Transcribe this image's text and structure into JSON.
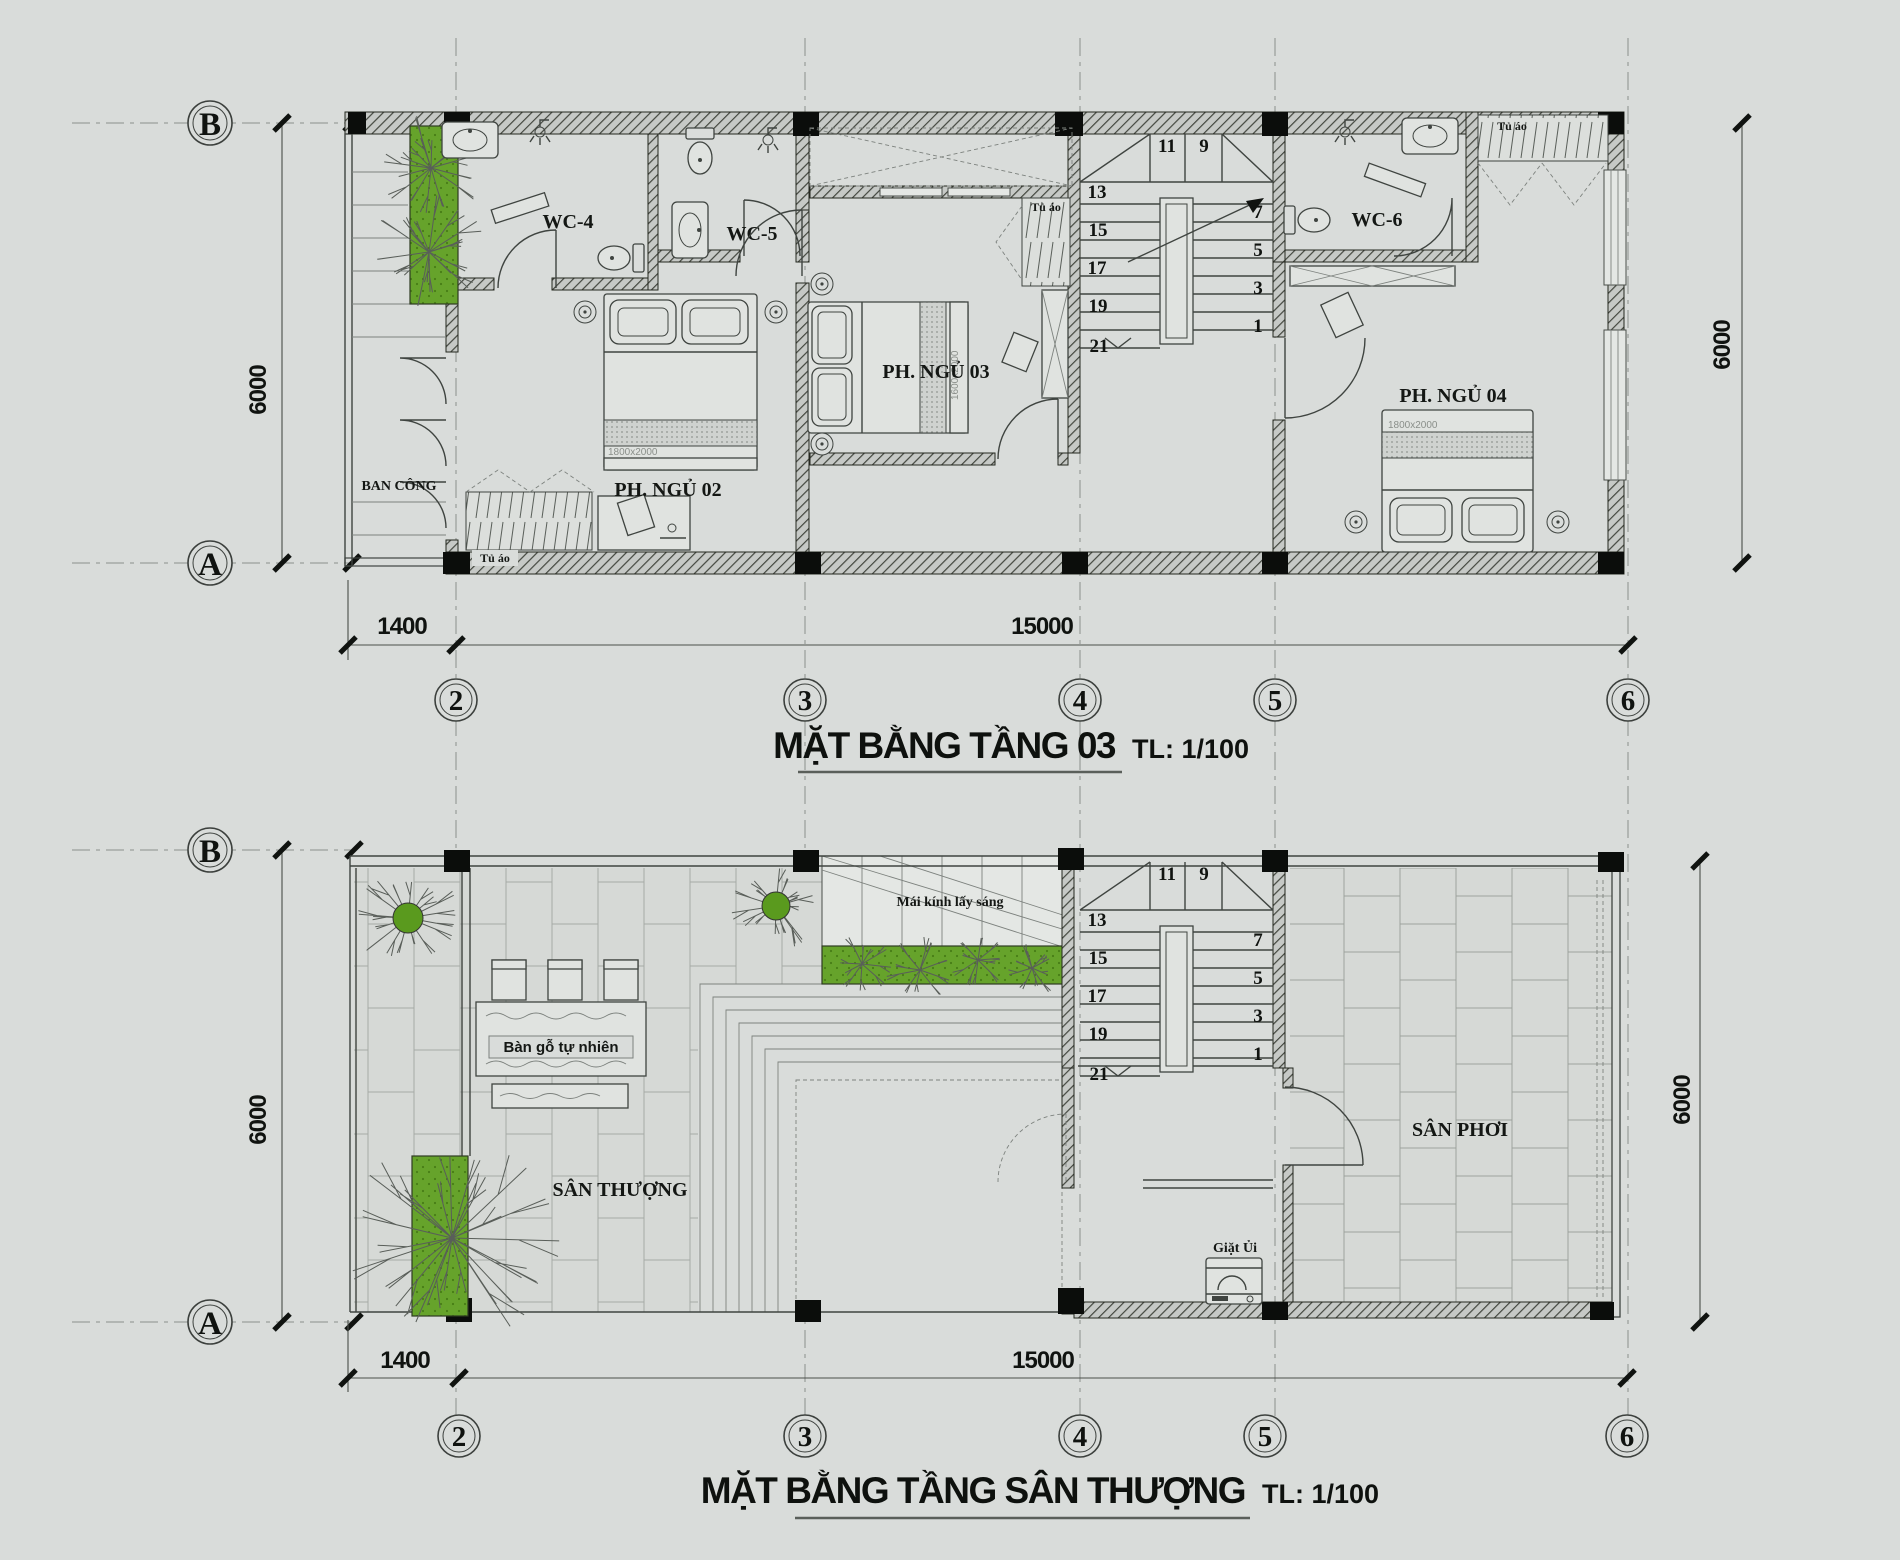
{
  "drawing": {
    "background": "#d9dcda",
    "accent_green": "#63a127",
    "plan1": {
      "title": "MẶT BẰNG TẦNG 03",
      "scale": "TL: 1/100",
      "rooms": {
        "wc4": "WC-4",
        "wc5": "WC-5",
        "wc6": "WC-6",
        "bedroom2": "PH. NGỦ 02",
        "bedroom3": "PH. NGỦ 03",
        "bedroom4": "PH. NGỦ 04",
        "balcony": "BAN CÔNG"
      },
      "wardrobe": "Tủ áo",
      "bed_size_2": "1800x2000",
      "bed_size_3": "1600x2000",
      "bed_size_4": "1800x2000"
    },
    "plan2": {
      "title": "MẶT BẰNG TẦNG SÂN THƯỢNG",
      "scale": "TL: 1/100",
      "rooms": {
        "terrace": "SÂN THƯỢNG",
        "drying_yard": "SÂN PHƠI",
        "laundry": "Giặt Ủi"
      },
      "skylight": "Mái kính lấy sáng",
      "table": "Bàn gỗ tự nhiên"
    },
    "grid": {
      "rows": [
        "B",
        "A"
      ],
      "cols": [
        "2",
        "3",
        "4",
        "5",
        "6"
      ]
    },
    "dimensions": {
      "depth": "6000",
      "balcony_width": "1400",
      "length": "15000"
    },
    "stairs": {
      "winder": [
        "11",
        "9"
      ],
      "left_flight": [
        "13",
        "15",
        "17",
        "19",
        "21"
      ],
      "right_flight": [
        "7",
        "5",
        "3",
        "1"
      ]
    }
  }
}
